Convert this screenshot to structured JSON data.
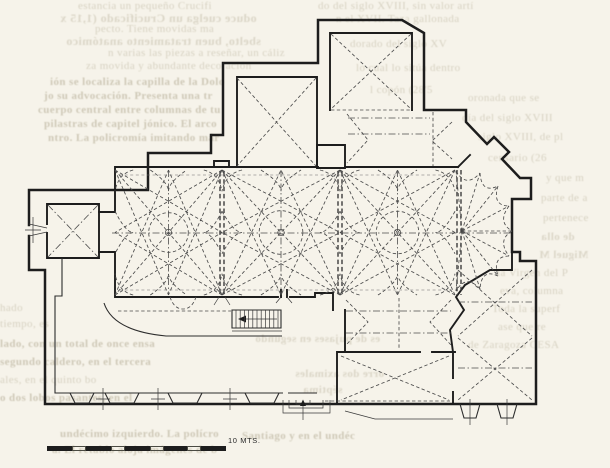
{
  "colors": {
    "paper": "#f6f3ea",
    "ink": "#1d1d1d",
    "ghost": "#8f8465"
  },
  "scale_bar": {
    "label": "10 MTS.",
    "segments": [
      {
        "type": "dark",
        "w": 25
      },
      {
        "type": "light",
        "w": 14
      },
      {
        "type": "dark",
        "w": 25
      },
      {
        "type": "light",
        "w": 14
      },
      {
        "type": "dark",
        "w": 25
      },
      {
        "type": "light",
        "w": 14
      },
      {
        "type": "dark",
        "w": 23
      },
      {
        "type": "light",
        "w": 14
      },
      {
        "type": "dark",
        "w": 25
      }
    ]
  },
  "ghost_text": {
    "items": [
      {
        "t": "estancia un pequeño Crucifi",
        "x": 78,
        "y": 0,
        "s": 11
      },
      {
        "t": "oduce cuelga un Crucificado (1,15 x",
        "x": 60,
        "y": 11,
        "s": 12,
        "m": true
      },
      {
        "t": "pecto. Tiene movidas ma",
        "x": 95,
        "y": 23,
        "s": 11
      },
      {
        "t": "sbelto, buen tratamiento anatómico",
        "x": 66,
        "y": 34,
        "s": 12,
        "m": true
      },
      {
        "t": "n varias las piezas a reseñar, un cáliz",
        "x": 108,
        "y": 47,
        "s": 11
      },
      {
        "t": "za movida y abundante decoración",
        "x": 86,
        "y": 60,
        "s": 11
      },
      {
        "t": "do del siglo XVIII, sin valor artí",
        "x": 318,
        "y": 0,
        "s": 11
      },
      {
        "t": "n el XVII. Taza gallonada",
        "x": 336,
        "y": 13,
        "s": 11
      },
      {
        "t": "dorado del siglo XV",
        "x": 350,
        "y": 38,
        "s": 11
      },
      {
        "t": "lo cual lo sitúa dentro",
        "x": 356,
        "y": 62,
        "s": 11
      },
      {
        "t": "l copón (28'5",
        "x": 370,
        "y": 84,
        "s": 11
      },
      {
        "t": "ión se localiza la capilla de la Dolo",
        "x": 50,
        "y": 76,
        "s": 11,
        "b": true
      },
      {
        "t": "jo su advocación. Presenta una tr",
        "x": 44,
        "y": 90,
        "s": 11,
        "b": true
      },
      {
        "t": "cuerpo central entre columnas de tu",
        "x": 38,
        "y": 104,
        "s": 11,
        "b": true
      },
      {
        "t": "pilastras de capitel jónico. El arco",
        "x": 44,
        "y": 118,
        "s": 11,
        "b": true
      },
      {
        "t": "ntro. La policromía imitando már",
        "x": 48,
        "y": 132,
        "s": 11,
        "b": true
      },
      {
        "t": "oronada que se",
        "x": 468,
        "y": 92,
        "s": 11
      },
      {
        "t": "día del siglo XVIII",
        "x": 462,
        "y": 112,
        "s": 11
      },
      {
        "t": "siglo XVIII, de pl",
        "x": 478,
        "y": 131,
        "s": 11
      },
      {
        "t": "censario (26",
        "x": 488,
        "y": 152,
        "s": 11
      },
      {
        "t": "y que m",
        "x": 546,
        "y": 172,
        "s": 11
      },
      {
        "t": "parte de a",
        "x": 541,
        "y": 192,
        "s": 11
      },
      {
        "t": "pertenece",
        "x": 543,
        "y": 212,
        "s": 11
      },
      {
        "t": "de olla",
        "x": 541,
        "y": 231,
        "s": 11,
        "m": true
      },
      {
        "t": "Miguel M",
        "x": 539,
        "y": 249,
        "s": 11,
        "m": true
      },
      {
        "t": "la Virgen del P",
        "x": 497,
        "y": 267,
        "s": 11
      },
      {
        "t": "eva, columna",
        "x": 500,
        "y": 285,
        "s": 11
      },
      {
        "t": "Toda la superf",
        "x": 492,
        "y": 303,
        "s": 11
      },
      {
        "t": "ase que re",
        "x": 498,
        "y": 321,
        "s": 11
      },
      {
        "t": "de Zaragoza CESA",
        "x": 468,
        "y": 339,
        "s": 11
      },
      {
        "t": "hado",
        "x": 0,
        "y": 302,
        "s": 11
      },
      {
        "t": "tiempo, es",
        "x": 0,
        "y": 318,
        "s": 11
      },
      {
        "t": "lado, con un total de once ensa",
        "x": 0,
        "y": 338,
        "s": 11,
        "b": true
      },
      {
        "t": "segundo caldero, en el tercera",
        "x": 0,
        "y": 356,
        "s": 11,
        "b": true
      },
      {
        "t": "ales, en el quinto bo",
        "x": 0,
        "y": 374,
        "s": 11
      },
      {
        "t": "o dos lobos pasantes, en el",
        "x": 0,
        "y": 392,
        "s": 11,
        "b": true
      },
      {
        "t": "es de pujases en segundo",
        "x": 255,
        "y": 333,
        "s": 11,
        "m": true
      },
      {
        "t": "orre dos aximales",
        "x": 295,
        "y": 368,
        "s": 11,
        "m": true
      },
      {
        "t": "séptima",
        "x": 303,
        "y": 384,
        "s": 11,
        "m": true
      },
      {
        "t": "undécimo izquierdo. La polícro",
        "x": 60,
        "y": 428,
        "s": 11,
        "b": true
      },
      {
        "t": "a. El retablo aloja imágenes de b",
        "x": 52,
        "y": 444,
        "s": 11,
        "b": true
      },
      {
        "t": "Santiago y en el undéc",
        "x": 242,
        "y": 430,
        "s": 11,
        "b": true
      }
    ]
  }
}
